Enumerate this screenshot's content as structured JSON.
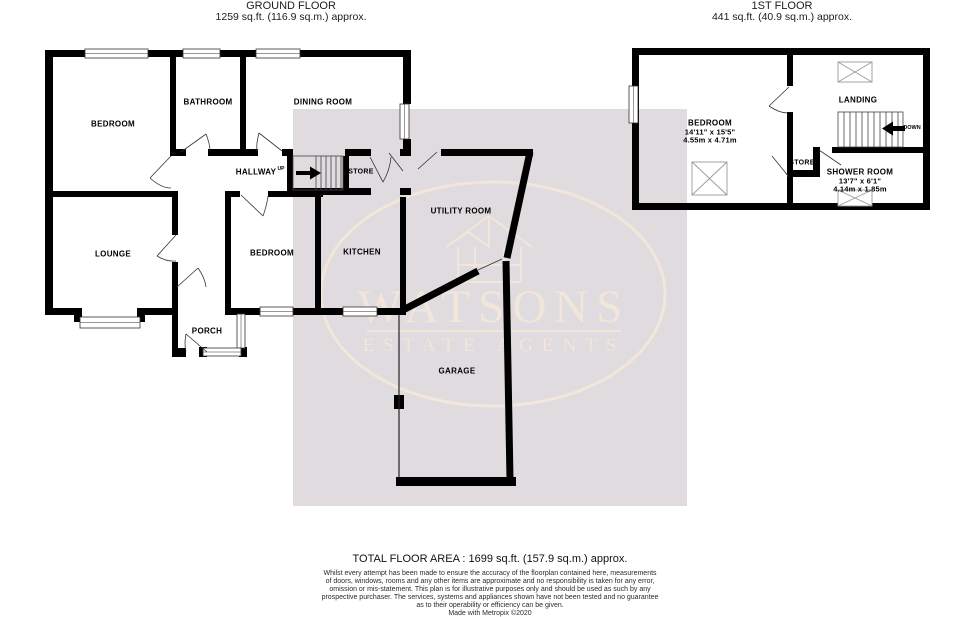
{
  "header": {
    "ground": {
      "title": "GROUND FLOOR",
      "area": "1259 sq.ft. (116.9 sq.m.) approx."
    },
    "first": {
      "title": "1ST FLOOR",
      "area": "441 sq.ft. (40.9 sq.m.) approx."
    }
  },
  "rooms_ground": {
    "bedroom1": "BEDROOM",
    "bathroom": "BATHROOM",
    "dining": "DINING ROOM",
    "hallway": "HALLWAY",
    "up": "UP",
    "store": "STORE",
    "lounge": "LOUNGE",
    "porch": "PORCH",
    "bedroom2": "BEDROOM",
    "kitchen": "KITCHEN",
    "utility": "UTILITY ROOM",
    "garage": "GARAGE"
  },
  "rooms_first": {
    "bedroom": {
      "label": "BEDROOM",
      "imperial": "14'11\" x 15'5\"",
      "metric": "4.55m x 4.71m"
    },
    "landing": "LANDING",
    "store": "STORE",
    "shower": {
      "label": "SHOWER ROOM",
      "imperial": "13'7\" x 6'1\"",
      "metric": "4.14m x 1.85m"
    },
    "down": "DOWN"
  },
  "watermark": {
    "name": "WATSONS",
    "tagline": "ESTATE AGENTS"
  },
  "footer": {
    "total": "TOTAL FLOOR AREA : 1699 sq.ft. (157.9 sq.m.) approx.",
    "lines": [
      "Whilst every attempt has been made to ensure the accuracy of the floorplan contained here, measurements",
      "of doors, windows, rooms and any other items are approximate and no responsibility is taken for any error,",
      "omission or mis-statement. This plan is for illustrative purposes only and should be used as such by any",
      "prospective purchaser. The services, systems and appliances shown have not been tested and no guarantee",
      "as to their operability or efficiency can be given.",
      "Made with Metropix ©2020"
    ]
  },
  "colors": {
    "wall": "#000000",
    "shade": "#e0dbdf",
    "watermark": "#f3e8d9"
  }
}
